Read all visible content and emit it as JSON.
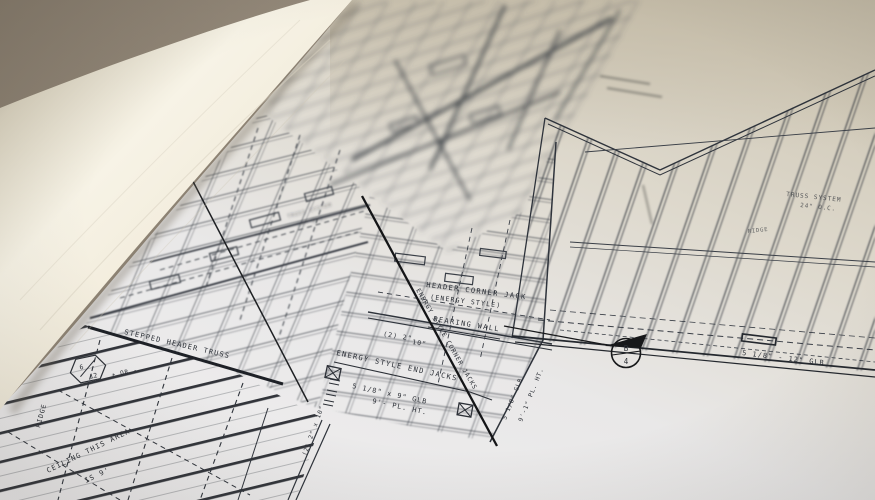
{
  "colors": {
    "background_tan": "#8e8375",
    "paper_roll_cream": "#f6f2e4",
    "page_white": "#e9e8e8",
    "ink": "#2b2f36",
    "black_marker": "#17181a"
  },
  "labels": {
    "header_jack_line1": "HEADER CORNER JACK",
    "header_jack_line2": "(ENERGY STYLE)",
    "bearing_wall": "BEARING WALL",
    "qty_2x2": "(2) 2\"",
    "qty_10": "10\"",
    "end_jacks": "ENERGY STYLE END JACKS",
    "glb_center": "5 1/8\" x 9\" GLB",
    "plate_height": "9'- PL. HT.",
    "corner_jacks_diagonal": "ENERGY STYLE CORNER JACKS",
    "stepped_header": "STEPPED HEADER TRUSS",
    "ridge_left": "RIDGE",
    "pitch_top": "6",
    "pitch_bottom": "12",
    "pitch_suffix": "+ OR -",
    "ceiling_line1": "CEILING THIS AREA",
    "ceiling_line2": "IS 9'",
    "vert_2x10": "(2) 2\" x 10\"",
    "vert_glb": "5 1/8\" GLB",
    "vert_plate": "9'-1\" PL. HT.",
    "glb_right": "5 1/8\" - 12\" GLB",
    "truss_system": "TRUSS SYSTEM",
    "truss_spacing": "24\" O.C.",
    "ridge_right": "RIDGE",
    "truss_center": "TRUSS SYSTEM",
    "truss_center_spacing": "24\" O.C."
  },
  "section_marker": {
    "top": "B",
    "bottom": "4"
  }
}
